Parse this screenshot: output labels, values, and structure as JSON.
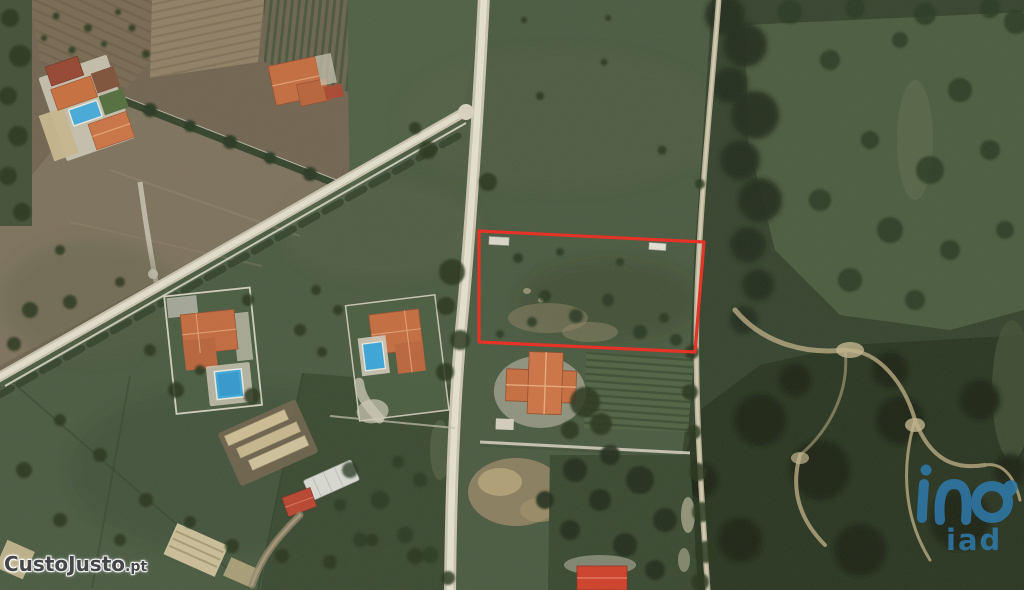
{
  "image": {
    "kind_label": "satellite-aerial-photo",
    "width_px": 1024,
    "height_px": 590
  },
  "plot_highlight": {
    "shape": "rectangle-outline",
    "color": "#e8251a"
  },
  "watermarks": {
    "custojusto": {
      "text": "CustoJusto",
      "suffix": ".pt",
      "color": "#45454a"
    },
    "iad": {
      "label": "iad",
      "icon": "iad-swirl-icon",
      "color": "#2f76a4"
    }
  },
  "terrain_colors": {
    "field_green": "#45553c",
    "forest_dark_green": "#2f3e28",
    "plowed_brown": "#6e604d",
    "road_beige": "#d6d0bd",
    "dirt_tan": "#96855f",
    "pool_blue": "#38a5da",
    "roof_orange": "#c4683a",
    "roof_red": "#c23220"
  }
}
